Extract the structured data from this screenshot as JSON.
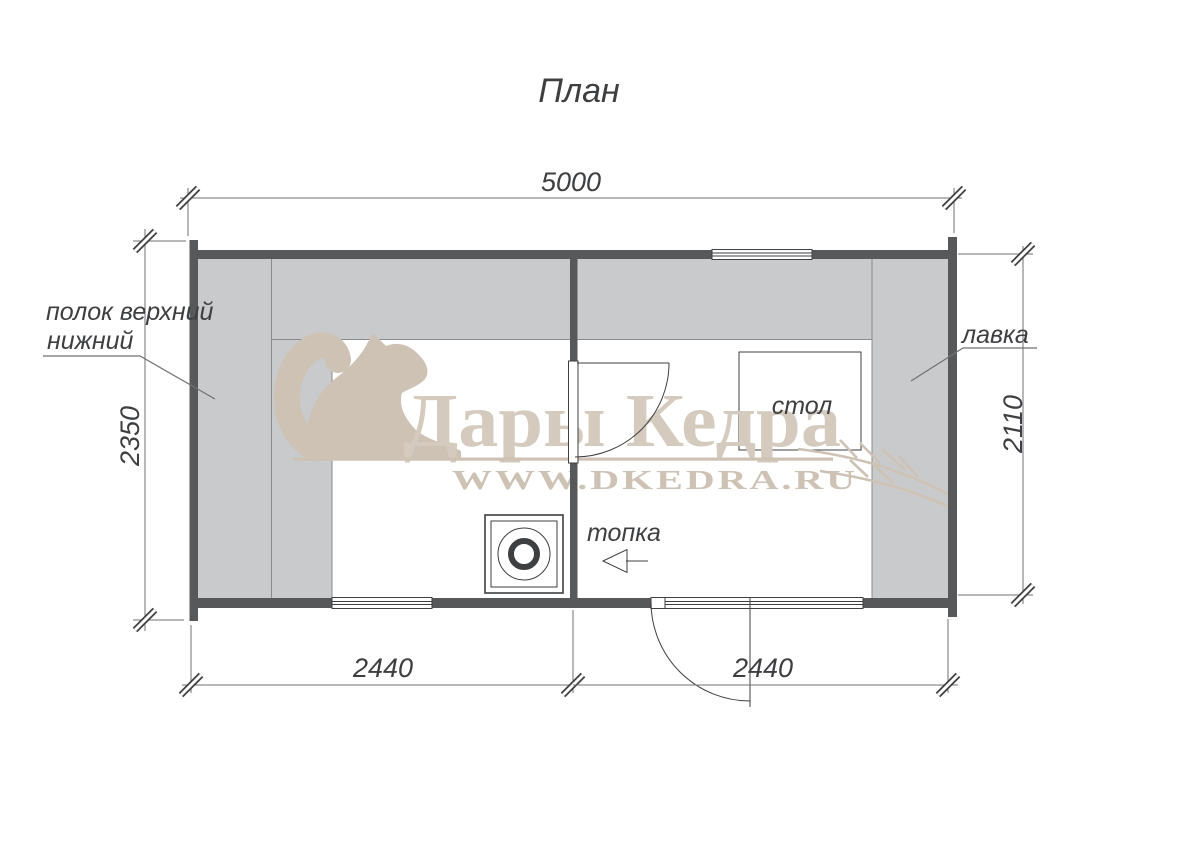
{
  "title": "План",
  "dimensions": {
    "total_width": "5000",
    "left_height": "2350",
    "right_height": "2110",
    "steam_room_width": "2440",
    "rest_room_width": "2440"
  },
  "labels": {
    "shelf_upper": "полок верхний",
    "shelf_lower": "нижний",
    "bench": "лавка",
    "table": "стол",
    "firebox": "топка"
  },
  "watermark": {
    "brand": "Дары Кедра",
    "site": "WWW.DKEDRA.RU"
  },
  "colors": {
    "wall": "#57585a",
    "bench": "#c9cacb",
    "bench-line": "#8a8b8e",
    "dim-line": "#707174",
    "draw-line": "#3e3f41",
    "text": "#3e3f41",
    "wm": "#cdc2b4",
    "wm-text": "#d4cabd"
  }
}
